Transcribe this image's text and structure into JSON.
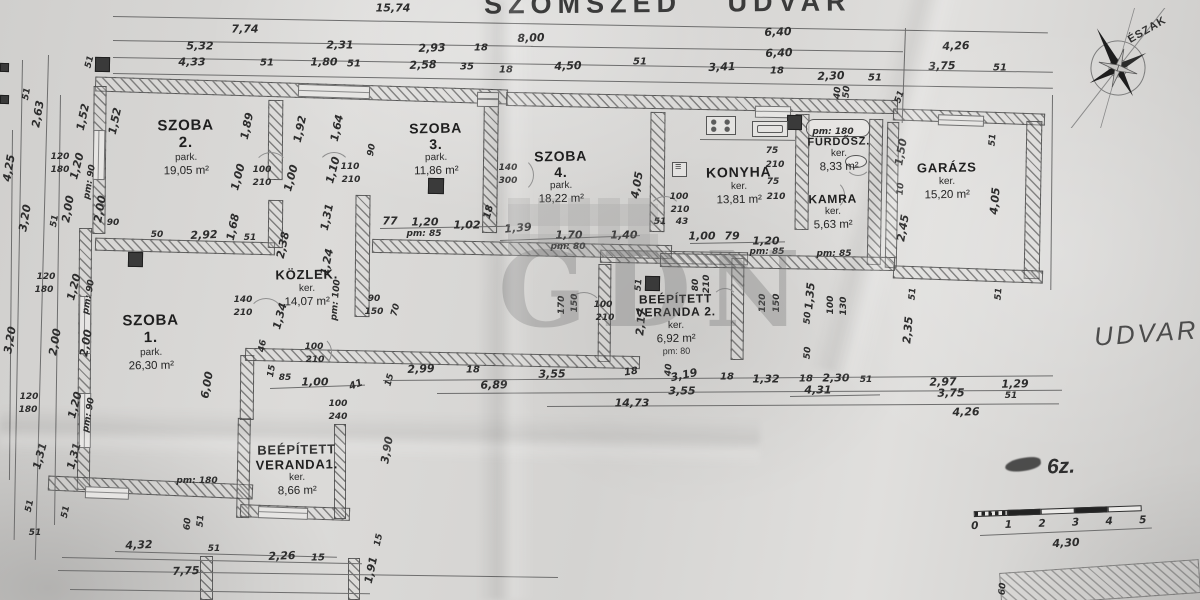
{
  "title_top": "SZOMSZÉD UDVAR",
  "compass": {
    "label": "ÉSZAK"
  },
  "yard_label": "UDVAR",
  "annotation": "6z.",
  "watermark": "GDN",
  "scale": {
    "ticks": [
      "0",
      "1",
      "2",
      "3",
      "4",
      "5"
    ]
  },
  "rooms": [
    {
      "lines": [
        "SZOBA",
        "2."
      ],
      "sub": "park.",
      "area": "19,05 m²",
      "x": 186,
      "y": 118,
      "fs": 15
    },
    {
      "lines": [
        "SZOBA",
        "3."
      ],
      "sub": "park.",
      "area": "11,86 m²",
      "x": 436,
      "y": 121,
      "fs": 14
    },
    {
      "lines": [
        "SZOBA",
        "4."
      ],
      "sub": "park.",
      "area": "18,22 m²",
      "x": 561,
      "y": 149,
      "fs": 14
    },
    {
      "lines": [
        "KONYHA"
      ],
      "sub": "ker.",
      "area": "13,81 m²",
      "x": 739,
      "y": 165,
      "fs": 14
    },
    {
      "lines": [
        "FÜRDŐSZ."
      ],
      "sub": "ker.",
      "area": "8,33 m²",
      "x": 839,
      "y": 136,
      "fs": 11
    },
    {
      "lines": [
        "KAMRA"
      ],
      "sub": "ker.",
      "area": "5,63 m²",
      "x": 833,
      "y": 193,
      "fs": 12
    },
    {
      "lines": [
        "GARÁZS"
      ],
      "sub": "ker.",
      "area": "15,20 m²",
      "x": 947,
      "y": 161,
      "fs": 13
    },
    {
      "lines": [
        "SZOBA",
        "1."
      ],
      "sub": "park.",
      "area": "26,30 m²",
      "x": 151,
      "y": 313,
      "fs": 15
    },
    {
      "lines": [
        "KÖZLEK."
      ],
      "sub": "ker.",
      "area": "14,07 m²",
      "x": 307,
      "y": 268,
      "fs": 13
    },
    {
      "lines": [
        "BEÉPÍTETT",
        "VERANDA1."
      ],
      "sub": "ker.",
      "area": "8,66 m²",
      "x": 297,
      "y": 443,
      "fs": 13
    },
    {
      "lines": [
        "BEÉPÍTETT",
        "VERANDA 2."
      ],
      "sub": "ker.",
      "area": "6,92 m²",
      "extra": "pm: 80",
      "x": 676,
      "y": 293,
      "fs": 12
    }
  ],
  "dims": [
    [
      "15,74",
      393,
      8,
      0
    ],
    [
      "7,74",
      245,
      29,
      0
    ],
    [
      "8,00",
      531,
      38,
      -2
    ],
    [
      "6,40",
      778,
      32,
      -2
    ],
    [
      "6,40",
      779,
      53,
      -2
    ],
    [
      "5,32",
      200,
      46,
      0
    ],
    [
      "2,31",
      340,
      45,
      0
    ],
    [
      "2,93",
      432,
      48,
      -2
    ],
    [
      "18",
      481,
      48,
      0,
      10
    ],
    [
      "4,50",
      568,
      66,
      -2
    ],
    [
      "51",
      640,
      62,
      0,
      10
    ],
    [
      "3,41",
      722,
      67,
      -2
    ],
    [
      "18",
      777,
      71,
      0,
      10
    ],
    [
      "2,30",
      831,
      76,
      -2
    ],
    [
      "51",
      875,
      78,
      0,
      10
    ],
    [
      "4,26",
      956,
      46,
      -2
    ],
    [
      "3,75",
      942,
      66,
      -2
    ],
    [
      "51",
      1000,
      68,
      0,
      10
    ],
    [
      "4,33",
      192,
      62,
      0
    ],
    [
      "51",
      267,
      63,
      0,
      10
    ],
    [
      "1,80",
      324,
      62,
      0
    ],
    [
      "51",
      354,
      64,
      0,
      10
    ],
    [
      "2,58",
      423,
      65,
      -2
    ],
    [
      "35",
      467,
      67,
      0,
      10
    ],
    [
      "18",
      506,
      70,
      0,
      10
    ],
    [
      "40",
      838,
      93,
      -85,
      9
    ],
    [
      "50",
      847,
      92,
      -85,
      9
    ],
    [
      "51",
      900,
      97,
      -70,
      9
    ],
    [
      "51",
      90,
      62,
      -75,
      9
    ],
    [
      "51",
      27,
      94,
      -80,
      9
    ],
    [
      "2,63",
      38,
      114,
      -80
    ],
    [
      "4,25",
      9,
      168,
      -80
    ],
    [
      "1,52",
      83,
      117,
      -78
    ],
    [
      "1,52",
      115,
      121,
      -78
    ],
    [
      "120",
      60,
      157,
      0,
      9
    ],
    [
      "180",
      60,
      170,
      0,
      9
    ],
    [
      "1,20",
      77,
      166,
      -75
    ],
    [
      "pm: 90",
      90,
      182,
      -80,
      9
    ],
    [
      "2,00",
      68,
      209,
      -80
    ],
    [
      "2,00",
      100,
      209,
      -80
    ],
    [
      "51",
      55,
      221,
      -80,
      9
    ],
    [
      "90",
      113,
      223,
      0,
      9
    ],
    [
      "3,20",
      25,
      218,
      -80
    ],
    [
      "3,20",
      10,
      340,
      -80
    ],
    [
      "120",
      46,
      277,
      0,
      9
    ],
    [
      "180",
      44,
      290,
      0,
      9
    ],
    [
      "1,20",
      74,
      287,
      -75
    ],
    [
      "pm: 90",
      89,
      297,
      -80,
      9
    ],
    [
      "2,00",
      55,
      342,
      -80
    ],
    [
      "2,00",
      86,
      343,
      -80
    ],
    [
      "120",
      29,
      397,
      0,
      9
    ],
    [
      "180",
      28,
      410,
      0,
      9
    ],
    [
      "1,20",
      75,
      405,
      -75
    ],
    [
      "pm: 90",
      89,
      415,
      -80,
      9
    ],
    [
      "1,31",
      40,
      456,
      -75
    ],
    [
      "1,31",
      74,
      456,
      -75
    ],
    [
      "1,89",
      247,
      126,
      -78
    ],
    [
      "1,92",
      300,
      129,
      -78
    ],
    [
      "1,64",
      337,
      128,
      -78
    ],
    [
      "1,00",
      238,
      177,
      -75
    ],
    [
      "100",
      262,
      170,
      0,
      9
    ],
    [
      "210",
      262,
      183,
      0,
      9
    ],
    [
      "1,00",
      291,
      178,
      -75
    ],
    [
      "1,10",
      333,
      170,
      -75
    ],
    [
      "110",
      350,
      167,
      0,
      9
    ],
    [
      "210",
      351,
      180,
      0,
      9
    ],
    [
      "90",
      372,
      150,
      -80,
      9
    ],
    [
      "50",
      157,
      235,
      0,
      9
    ],
    [
      "2,92",
      204,
      235,
      -2
    ],
    [
      "1,68",
      233,
      227,
      -78
    ],
    [
      "51",
      250,
      238,
      0,
      9
    ],
    [
      "2,38",
      283,
      245,
      -78
    ],
    [
      "1,31",
      327,
      217,
      -78
    ],
    [
      "1,24",
      327,
      262,
      -78
    ],
    [
      "77",
      390,
      221,
      0
    ],
    [
      "1,20",
      425,
      222,
      0
    ],
    [
      "pm: 85",
      424,
      234,
      0,
      9
    ],
    [
      "1,02",
      467,
      225,
      0
    ],
    [
      "18",
      489,
      212,
      -75,
      10
    ],
    [
      "1,39",
      518,
      228,
      -5
    ],
    [
      "1,70",
      569,
      235,
      0
    ],
    [
      "pm: 80",
      568,
      247,
      0,
      9
    ],
    [
      "1,40",
      624,
      235,
      0
    ],
    [
      "4,05",
      637,
      185,
      -80
    ],
    [
      "100",
      679,
      197,
      0,
      9
    ],
    [
      "210",
      680,
      210,
      0,
      9
    ],
    [
      "51",
      660,
      222,
      0,
      9
    ],
    [
      "43",
      682,
      222,
      0,
      9
    ],
    [
      "1,00",
      702,
      236,
      0
    ],
    [
      "79",
      732,
      236,
      0
    ],
    [
      "1,20",
      766,
      241,
      0
    ],
    [
      "pm: 85",
      767,
      252,
      0,
      9
    ],
    [
      "pm: 85",
      834,
      254,
      0,
      9
    ],
    [
      "75",
      772,
      151,
      0,
      9
    ],
    [
      "210",
      775,
      165,
      0,
      9
    ],
    [
      "75",
      773,
      182,
      0,
      9
    ],
    [
      "210",
      776,
      197,
      0,
      9
    ],
    [
      "pm: 180",
      833,
      132,
      0,
      9
    ],
    [
      "1,50",
      901,
      152,
      -80
    ],
    [
      "10",
      901,
      189,
      -85,
      9
    ],
    [
      "2,45",
      903,
      228,
      -80
    ],
    [
      "51",
      993,
      140,
      -85,
      9
    ],
    [
      "4,05",
      995,
      201,
      -85
    ],
    [
      "51",
      913,
      294,
      -85,
      9
    ],
    [
      "2,35",
      908,
      330,
      -85
    ],
    [
      "51",
      999,
      294,
      -85,
      9
    ],
    [
      "120",
      763,
      303,
      -90,
      9
    ],
    [
      "150",
      777,
      303,
      -90,
      9
    ],
    [
      "1,35",
      810,
      296,
      -85
    ],
    [
      "50",
      808,
      318,
      -85,
      9
    ],
    [
      "100",
      831,
      305,
      -90,
      9
    ],
    [
      "130",
      844,
      306,
      -90,
      9
    ],
    [
      "50",
      808,
      353,
      -85,
      9
    ],
    [
      "51",
      639,
      285,
      -85,
      9
    ],
    [
      "2,17",
      641,
      322,
      -85
    ],
    [
      "80",
      696,
      285,
      -90,
      9
    ],
    [
      "210",
      707,
      284,
      -90,
      9
    ],
    [
      "170",
      562,
      305,
      -90,
      9
    ],
    [
      "150",
      575,
      303,
      -90,
      9
    ],
    [
      "100",
      603,
      305,
      0,
      9
    ],
    [
      "210",
      605,
      318,
      0,
      9
    ],
    [
      "140",
      243,
      300,
      0,
      9
    ],
    [
      "210",
      243,
      313,
      0,
      9
    ],
    [
      "1,34",
      280,
      316,
      -75
    ],
    [
      "100",
      314,
      347,
      0,
      9
    ],
    [
      "210",
      315,
      360,
      0,
      9
    ],
    [
      "46",
      263,
      346,
      -80,
      9
    ],
    [
      "15",
      272,
      371,
      -80,
      9
    ],
    [
      "85",
      285,
      378,
      0,
      9
    ],
    [
      "1,00",
      315,
      382,
      0
    ],
    [
      "41",
      356,
      385,
      -20,
      10
    ],
    [
      "100",
      338,
      404,
      0,
      9
    ],
    [
      "240",
      338,
      417,
      0,
      9
    ],
    [
      "90",
      374,
      299,
      0,
      9
    ],
    [
      "150",
      374,
      312,
      0,
      9
    ],
    [
      "70",
      396,
      310,
      -75,
      9
    ],
    [
      "pm: 100",
      336,
      300,
      -85,
      9
    ],
    [
      "140",
      508,
      168,
      0,
      9
    ],
    [
      "300",
      508,
      181,
      0,
      9
    ],
    [
      "6,00",
      207,
      385,
      -80
    ],
    [
      "3,90",
      387,
      450,
      -80
    ],
    [
      "15",
      379,
      540,
      -78,
      9
    ],
    [
      "1,91",
      371,
      570,
      -78
    ],
    [
      "2,99",
      421,
      369,
      -2
    ],
    [
      "18",
      473,
      370,
      0,
      10
    ],
    [
      "3,55",
      552,
      374,
      -1
    ],
    [
      "6,89",
      494,
      385,
      -1
    ],
    [
      "15",
      390,
      380,
      -75,
      9
    ],
    [
      "18",
      631,
      372,
      -8,
      10
    ],
    [
      "40",
      669,
      370,
      -85,
      9
    ],
    [
      "3,19",
      684,
      375,
      -12
    ],
    [
      "18",
      727,
      377,
      0,
      10
    ],
    [
      "1,32",
      766,
      379,
      0
    ],
    [
      "3,55",
      682,
      391,
      0
    ],
    [
      "14,73",
      632,
      403,
      0
    ],
    [
      "18",
      806,
      379,
      0,
      10
    ],
    [
      "2,30",
      836,
      378,
      0
    ],
    [
      "51",
      866,
      380,
      0,
      9
    ],
    [
      "4,31",
      818,
      390,
      0
    ],
    [
      "2,97",
      943,
      382,
      -1
    ],
    [
      "3,75",
      951,
      393,
      -1
    ],
    [
      "1,29",
      1015,
      384,
      -1
    ],
    [
      "51",
      1011,
      396,
      0,
      9
    ],
    [
      "4,26",
      966,
      412,
      -1
    ],
    [
      "51",
      30,
      506,
      -78,
      9
    ],
    [
      "51",
      66,
      512,
      -78,
      9
    ],
    [
      "51",
      35,
      533,
      0,
      9
    ],
    [
      "pm: 180",
      197,
      481,
      0,
      9
    ],
    [
      "60",
      188,
      524,
      -85,
      9
    ],
    [
      "51",
      201,
      521,
      -85,
      9
    ],
    [
      "4,32",
      139,
      545,
      -2
    ],
    [
      "51",
      214,
      549,
      0,
      9
    ],
    [
      "2,26",
      282,
      556,
      -2
    ],
    [
      "15",
      318,
      558,
      0,
      10
    ],
    [
      "7,75",
      186,
      571,
      -2
    ],
    [
      "60",
      1003,
      589,
      -85,
      9
    ],
    [
      "4,30",
      1066,
      543,
      -3
    ]
  ],
  "walls": [
    [
      95,
      83,
      413,
      15,
      1.8
    ],
    [
      506,
      96,
      392,
      14,
      1.2
    ],
    [
      893,
      111,
      152,
      12,
      2
    ],
    [
      93,
      86,
      13,
      148,
      0.5
    ],
    [
      78,
      228,
      13,
      262,
      0.5
    ],
    [
      48,
      480,
      205,
      15,
      2.5
    ],
    [
      237,
      418,
      13,
      100,
      1
    ],
    [
      240,
      506,
      110,
      13,
      2
    ],
    [
      334,
      424,
      12,
      95,
      0
    ],
    [
      240,
      355,
      14,
      65,
      0.5
    ],
    [
      95,
      240,
      180,
      13,
      1.5
    ],
    [
      268,
      100,
      15,
      80,
      0.5
    ],
    [
      268,
      200,
      15,
      48,
      0.5
    ],
    [
      355,
      195,
      15,
      122,
      0.5
    ],
    [
      483,
      95,
      15,
      138,
      0.8
    ],
    [
      650,
      112,
      15,
      120,
      0.5
    ],
    [
      795,
      114,
      14,
      116,
      0.5
    ],
    [
      868,
      119,
      14,
      146,
      1
    ],
    [
      886,
      122,
      12,
      146,
      1
    ],
    [
      1025,
      121,
      16,
      158,
      1
    ],
    [
      893,
      268,
      150,
      13,
      2
    ],
    [
      600,
      251,
      148,
      13,
      1
    ],
    [
      598,
      264,
      13,
      98,
      0.5
    ],
    [
      731,
      258,
      13,
      102,
      0.5
    ],
    [
      372,
      242,
      300,
      14,
      1.2
    ],
    [
      660,
      255,
      235,
      14,
      1
    ],
    [
      245,
      352,
      395,
      13,
      1.2
    ],
    [
      200,
      556,
      13,
      44,
      0
    ],
    [
      348,
      558,
      12,
      42,
      0
    ],
    [
      1000,
      566,
      200,
      34,
      -4
    ]
  ],
  "lines": [
    [
      113,
      16,
      935,
      1,
      "h"
    ],
    [
      113,
      40,
      420,
      0.8,
      "h"
    ],
    [
      531,
      46,
      372,
      0.8,
      "h"
    ],
    [
      113,
      57,
      940,
      0.9,
      "h"
    ],
    [
      113,
      73,
      940,
      0.9,
      "h"
    ],
    [
      383,
      380,
      670,
      -0.4,
      "h"
    ],
    [
      437,
      393,
      625,
      -0.3,
      "h"
    ],
    [
      547,
      406,
      512,
      -0.3,
      "h"
    ],
    [
      115,
      551,
      222,
      1.5,
      "h"
    ],
    [
      58,
      570,
      500,
      0.8,
      "h"
    ],
    [
      62,
      557,
      300,
      1.2,
      "h"
    ],
    [
      70,
      589,
      300,
      0.8,
      "h"
    ],
    [
      980,
      535,
      172,
      -2.5,
      "h"
    ],
    [
      700,
      139,
      95,
      0.5,
      "h"
    ],
    [
      380,
      228,
      130,
      -1,
      "h"
    ],
    [
      500,
      240,
      140,
      -2,
      "h"
    ],
    [
      690,
      243,
      95,
      -1,
      "h"
    ],
    [
      270,
      388,
      95,
      -2,
      "h"
    ],
    [
      790,
      396,
      90,
      -1,
      "h"
    ],
    [
      22,
      60,
      480,
      1,
      "v"
    ],
    [
      48,
      55,
      505,
      1.5,
      "v"
    ],
    [
      12,
      130,
      350,
      0.5,
      "v"
    ],
    [
      905,
      28,
      95,
      2,
      "v"
    ],
    [
      1052,
      95,
      195,
      0.5,
      "v"
    ],
    [
      60,
      95,
      430,
      0.8,
      "v"
    ]
  ],
  "windows": [
    [
      298,
      85,
      72,
      13,
      1.8,
      "h"
    ],
    [
      477,
      92,
      22,
      15,
      1,
      "h"
    ],
    [
      755,
      106,
      36,
      12,
      1,
      "h"
    ],
    [
      938,
      115,
      46,
      11,
      2,
      "h"
    ],
    [
      93,
      130,
      12,
      50,
      1,
      "v"
    ],
    [
      79,
      296,
      12,
      58,
      0.5,
      "v"
    ],
    [
      79,
      393,
      12,
      55,
      0.5,
      "v"
    ],
    [
      85,
      487,
      44,
      12,
      2,
      "h"
    ],
    [
      258,
      507,
      50,
      12,
      2,
      "h"
    ]
  ],
  "chimneys": [
    [
      95,
      57,
      15
    ],
    [
      128,
      252,
      15
    ],
    [
      428,
      178,
      16
    ],
    [
      645,
      276,
      15
    ],
    [
      787,
      115,
      15
    ],
    [
      0,
      95,
      9
    ],
    [
      0,
      63,
      9
    ]
  ],
  "arcs": [
    [
      253,
      152,
      36,
      0
    ],
    [
      317,
      152,
      34,
      0
    ],
    [
      498,
      157,
      36,
      90
    ],
    [
      565,
      292,
      38,
      0
    ],
    [
      648,
      196,
      34,
      0
    ],
    [
      815,
      180,
      30,
      90
    ],
    [
      845,
      150,
      26,
      180
    ],
    [
      248,
      298,
      36,
      0
    ],
    [
      300,
      336,
      32,
      90
    ],
    [
      712,
      288,
      26,
      0
    ]
  ],
  "fixtures": [
    [
      "stove",
      706,
      116,
      30,
      19
    ],
    [
      "sink",
      752,
      121,
      36,
      16
    ],
    [
      "tub",
      806,
      119,
      64,
      18
    ],
    [
      "wc",
      845,
      155,
      22,
      13
    ],
    [
      "boiler",
      672,
      162,
      15,
      15
    ]
  ]
}
